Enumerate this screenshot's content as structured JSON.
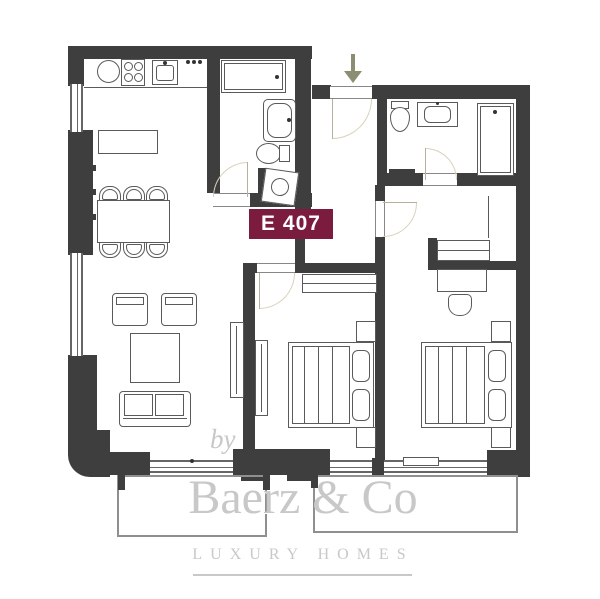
{
  "unit_badge": {
    "label": "E 407"
  },
  "entrance_arrow": {
    "direction": "down"
  },
  "watermark": {
    "prefix": "by",
    "brand": "Baerz & Co",
    "tagline": "LUXURY HOMES"
  },
  "colors": {
    "wall": "#3e3e3e",
    "line": "#5a5a5a",
    "door_arc": "#d8d2bc",
    "badge_bg": "#7b1c3e",
    "badge_text": "#ffffff",
    "arrow": "#8d8d71",
    "watermark": "#c8c8c8",
    "balcony_line": "#8f8f8f",
    "background": "#ffffff"
  },
  "fixtures": [
    "entrance-arrow",
    "entry-door",
    "kitchen-sink-round",
    "stove",
    "kitchen-sink-square",
    "kitchen-counter",
    "kitchen-island",
    "dining-table",
    "dining-chair",
    "shower",
    "bathtub",
    "toilet",
    "washing-machine",
    "washbasin",
    "wardrobe",
    "closet",
    "desk",
    "desk-chair",
    "armchair",
    "coffee-table",
    "sofa",
    "tv-cabinet",
    "double-bed",
    "nightstand",
    "pillow",
    "balcony",
    "window",
    "door-swing"
  ]
}
